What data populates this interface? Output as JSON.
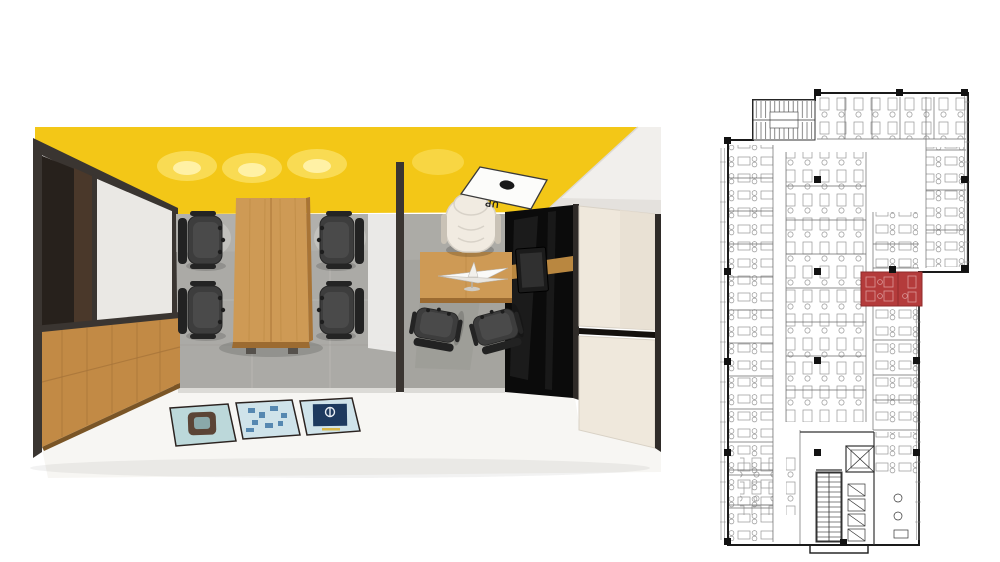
{
  "page": {
    "background": "#ffffff"
  },
  "render": {
    "type": "3d-cutaway-top-view-office",
    "ceiling_sign": {
      "label": "UP",
      "logo": "black-dot"
    },
    "rooms": [
      "meeting-room",
      "manager-office"
    ],
    "colors": {
      "yellow": "#F3C717",
      "glow": "#FBE268",
      "soffit": "#F1EFEC",
      "frame": "#3A3531",
      "wood": "#C28A45",
      "wood_light": "#CE9A55",
      "wood_dark": "#9C6B31",
      "floor_gray": "#ABAAA6",
      "floor_gray2": "#A5A49F",
      "white_floor": "#F7F6F3",
      "panel_white": "#EAE8E4",
      "cream": "#EFE8DC",
      "cream2": "#E7DFD2",
      "black_gloss": "#0B0B0B",
      "chair": "#3D3D3D",
      "chair_dark": "#242424",
      "exec": "#F1EBE1",
      "mat_teal": "#BCD8DA",
      "mat_blue": "#CFE3EA",
      "navy": "#1D3A5F",
      "brown": "#5B4436"
    }
  },
  "floorplan": {
    "type": "office-floor-plan",
    "highlighted_rooms": 2,
    "colors": {
      "plan_line": "#3C3C3C",
      "plan_light": "#8A8A8A",
      "red": "#B43B3B",
      "red_dark": "#8F2B2B",
      "red_light": "#DB9A9A",
      "col": "#121212"
    }
  }
}
